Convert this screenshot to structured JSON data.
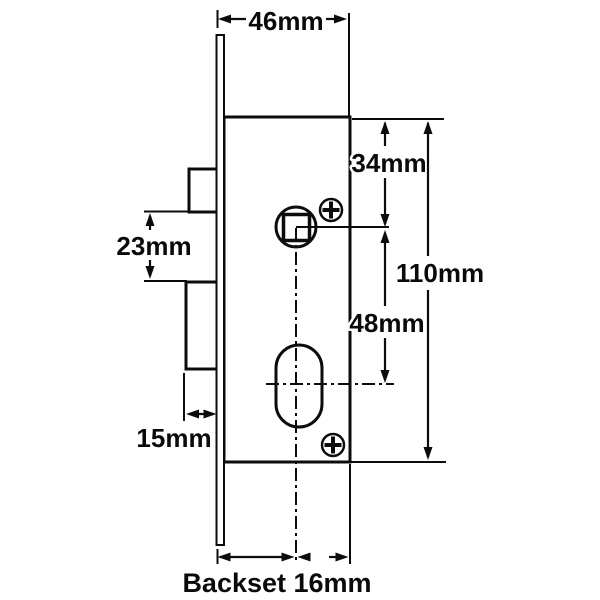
{
  "diagram": {
    "type": "technical-dimension-drawing",
    "subject": "mortice lock case with faceplate, latch bolt, deadbolt, spindle follower and oval cylinder hole",
    "colors": {
      "line": "#0c0c0c",
      "background": "#ffffff"
    },
    "labels": {
      "case_width": "46mm",
      "top_to_spindle": "34mm",
      "overall_height": "110mm",
      "spindle_to_cylinder": "48mm",
      "between_bolts": "23mm",
      "bolt_projection": "15mm",
      "backset": "Backset 16mm"
    },
    "dimension_values_mm": {
      "case_width": 46,
      "top_to_spindle": 34,
      "overall_height": 110,
      "spindle_to_cylinder": 48,
      "between_bolts": 23,
      "bolt_projection": 15,
      "backset": 16
    }
  }
}
